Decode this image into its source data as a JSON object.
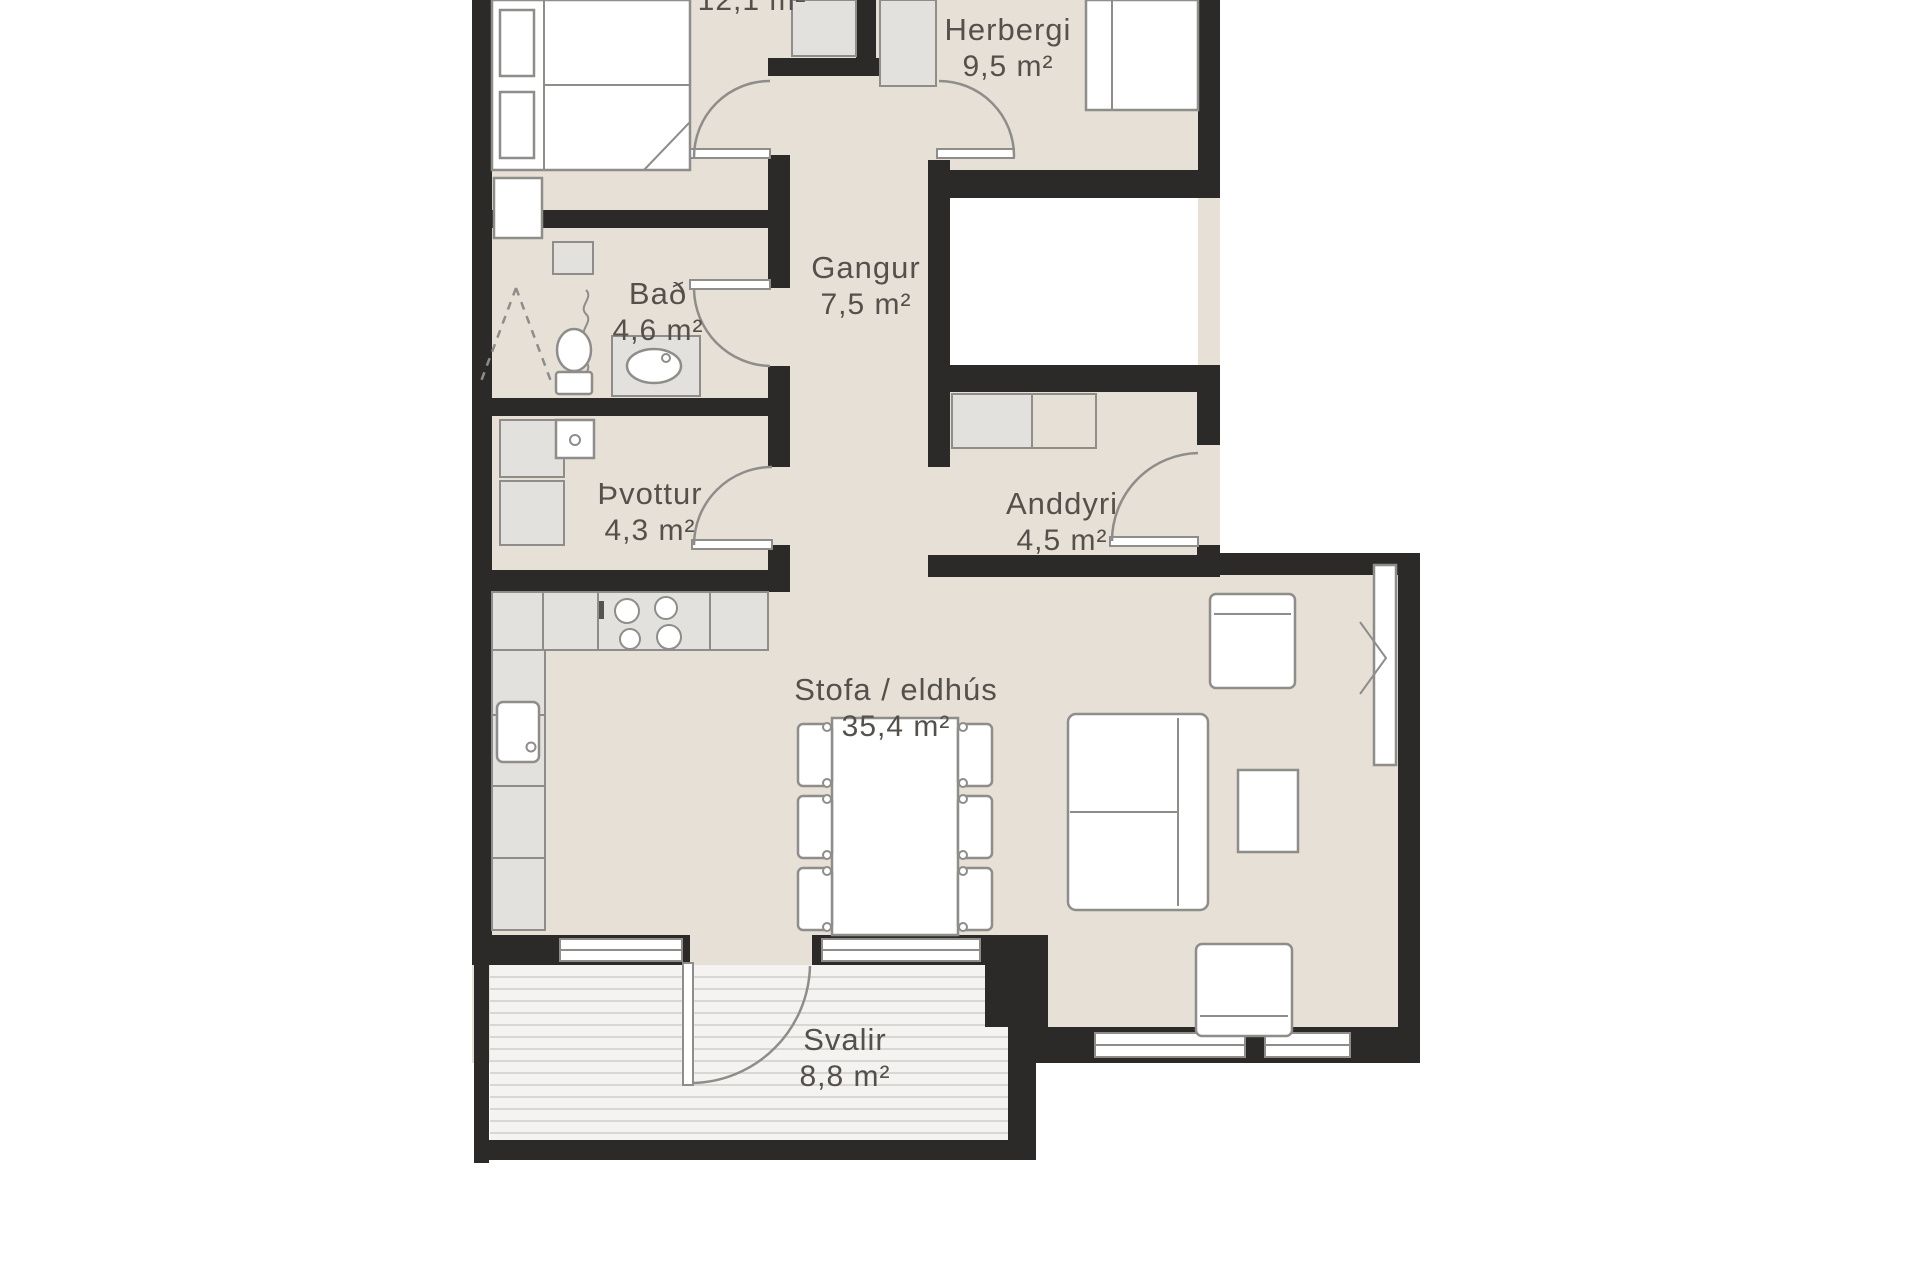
{
  "title": "Apartment floor plan",
  "colors": {
    "bg": "#ffffff",
    "floor": "#e7e0d7",
    "wall": "#2b2a28",
    "deck": "#f4f3f1",
    "deckline": "#d9d7d3",
    "furnwhite": "#ffffff",
    "furngray": "#e2e1dd",
    "stroke": "#8e8d8a",
    "text": "#54504b"
  },
  "rooms": [
    {
      "id": "svefnherbergi",
      "name": "",
      "area": "12,1 m²"
    },
    {
      "id": "herbergi",
      "name": "Herbergi",
      "area": "9,5 m²"
    },
    {
      "id": "gangur",
      "name": "Gangur",
      "area": "7,5 m²"
    },
    {
      "id": "bad",
      "name": "Bað",
      "area": "4,6 m²"
    },
    {
      "id": "thvottur",
      "name": "Þvottur",
      "area": "4,3 m²"
    },
    {
      "id": "anddyri",
      "name": "Anddyri",
      "area": "4,5 m²"
    },
    {
      "id": "stofa",
      "name": "Stofa / eldhús",
      "area": "35,4 m²"
    },
    {
      "id": "svalir",
      "name": "Svalir",
      "area": "8,8 m²"
    }
  ]
}
